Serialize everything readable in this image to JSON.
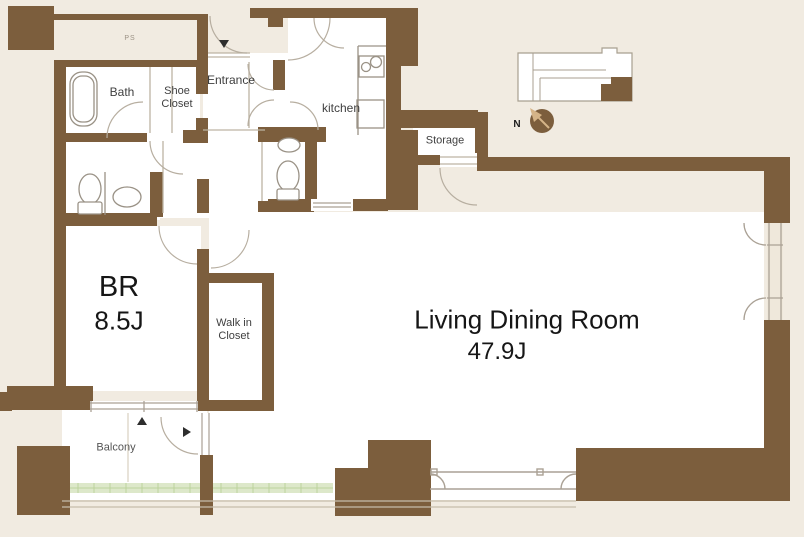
{
  "floor_plan": {
    "labels": {
      "ps": "PS",
      "bath": "Bath",
      "shoe_closet": "Shoe Closet",
      "entrance": "Entrance",
      "kitchen": "kitchen",
      "storage": "Storage",
      "bedroom_name": "BR",
      "bedroom_size": "8.5J",
      "walk_in_closet": "Walk in Closet",
      "living_dining_name": "Living Dining Room",
      "living_dining_size": "47.9J",
      "balcony": "Balcony",
      "compass_north": "N"
    },
    "colors": {
      "wall": "#7c5e3d",
      "background": "#f1ebe1",
      "room_fill": "#ffffff",
      "greenery": "#dde8ca",
      "fixture_line": "#a8a094"
    },
    "icons": [
      "bathtub-icon",
      "toilet-icon",
      "washbasin-icon",
      "stove-icon",
      "entrance-arrow-icon",
      "balcony-arrow-up-icon",
      "balcony-arrow-right-icon",
      "compass-icon",
      "key-plan"
    ]
  }
}
